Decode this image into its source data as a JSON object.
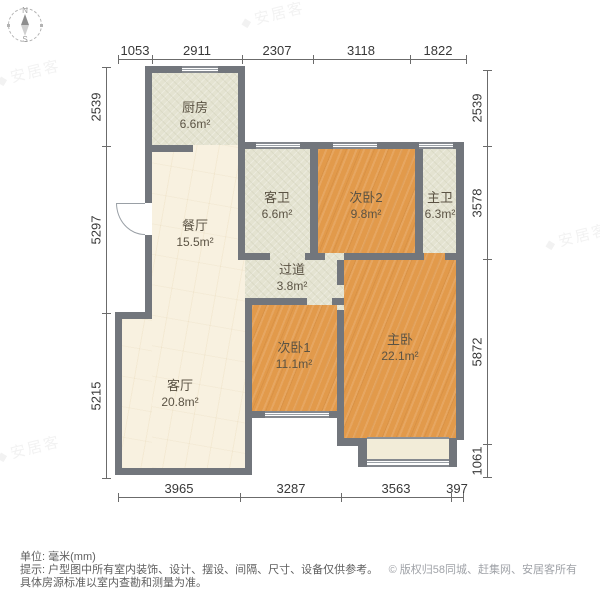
{
  "compass": {
    "north": "N",
    "south": "S"
  },
  "watermark": {
    "brand": "安居客",
    "logo_glyph": "◆"
  },
  "rooms": [
    {
      "id": "kitchen",
      "name": "厨房",
      "area": "6.6m²"
    },
    {
      "id": "dining",
      "name": "餐厅",
      "area": "15.5m²"
    },
    {
      "id": "guest-bath",
      "name": "客卫",
      "area": "6.6m²"
    },
    {
      "id": "bedroom2",
      "name": "次卧2",
      "area": "9.8m²"
    },
    {
      "id": "master-bath",
      "name": "主卫",
      "area": "6.3m²"
    },
    {
      "id": "hallway",
      "name": "过道",
      "area": "3.8m²"
    },
    {
      "id": "bedroom1",
      "name": "次卧1",
      "area": "11.1m²"
    },
    {
      "id": "master-bedroom",
      "name": "主卧",
      "area": "22.1m²"
    },
    {
      "id": "living",
      "name": "客厅",
      "area": "20.8m²"
    }
  ],
  "dimensions": {
    "top": [
      "1053",
      "2911",
      "2307",
      "3118",
      "1822"
    ],
    "left": [
      "2539",
      "5297",
      "5215"
    ],
    "right": [
      "2539",
      "3578",
      "5872",
      "1061"
    ],
    "bottom": [
      "3965",
      "3287",
      "3563",
      "397"
    ]
  },
  "footer": {
    "unit": "单位: 毫米(mm)",
    "tip": "提示: 户型图中所有室内装饰、设计、摆设、间隔、尺寸、设备仅供参考。",
    "tip2": "具体房源标准以室内查勘和测量为准。",
    "copyright": "© 版权归58同城、赶集网、安居客所有"
  },
  "colors": {
    "wall": "#72767c",
    "wood": "#e29a4b",
    "tile": "#e4e3d1",
    "marble": "#f8f1e0",
    "balcony": "#f2ecd8"
  }
}
